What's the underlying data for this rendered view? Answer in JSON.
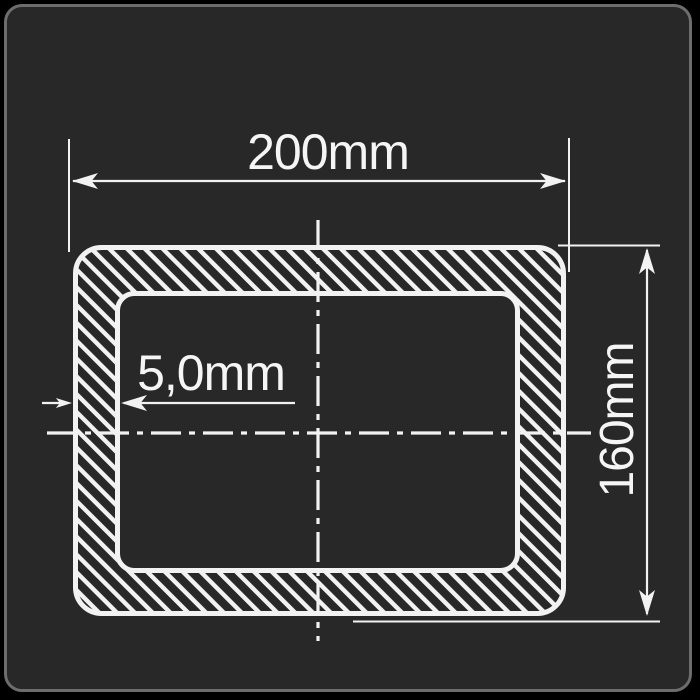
{
  "drawing": {
    "type": "technical-cross-section",
    "subject": "rectangular hollow tube profile with hatched walls",
    "dimensions": {
      "width_label": "200mm",
      "height_label": "160mm",
      "wall_thickness_label": "5,0mm"
    },
    "colors": {
      "page_background": "#000000",
      "card_fill": "#282828",
      "card_border": "#6d6d6d",
      "line": "#f2f2f2",
      "text": "#f5f5f5"
    }
  }
}
